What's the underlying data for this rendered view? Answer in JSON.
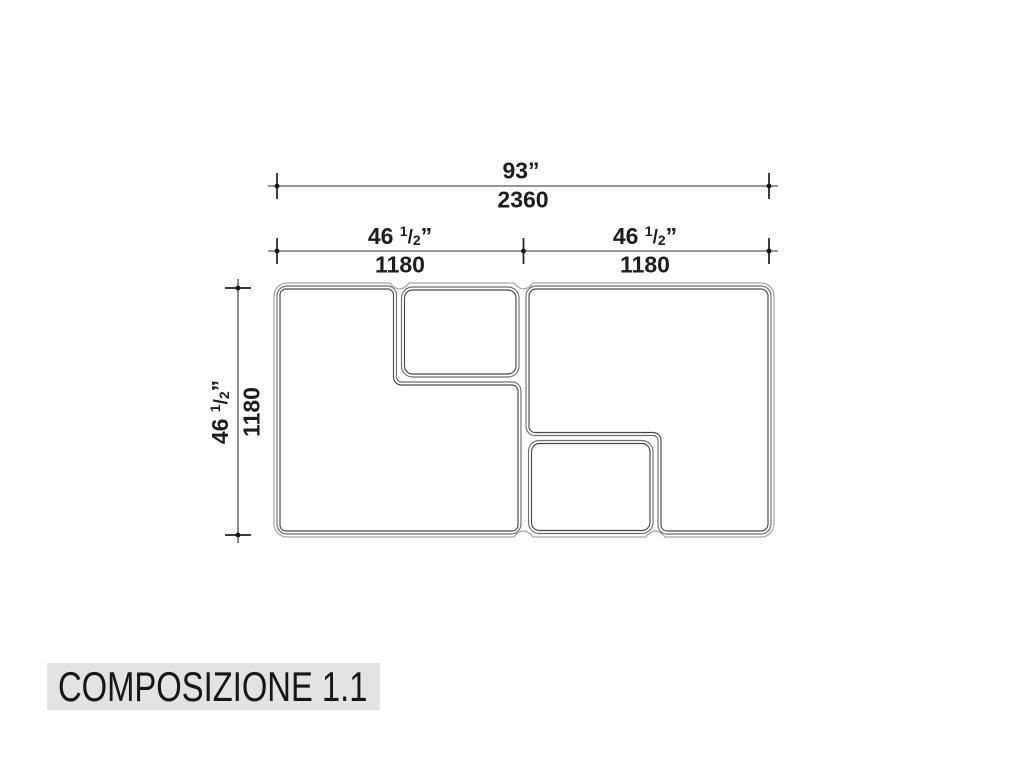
{
  "title": {
    "text": "COMPOSIZIONE 1.1"
  },
  "colors": {
    "background": "#ffffff",
    "title_bar": "#e3e3e3",
    "dimension_lines": "#2f2f2f",
    "outline_envelope": "#a6a6a6",
    "outline_outer": "#6e6e6e",
    "outline_inner": "#474747",
    "text": "#1d1d1d"
  },
  "dimensions": {
    "overall_width": {
      "inches": "93”",
      "mm": "2360"
    },
    "left_half_width": {
      "whole": "46",
      "num": "1",
      "slash": "/",
      "den": "2",
      "quote": "”",
      "mm": "1180"
    },
    "right_half_width": {
      "whole": "46",
      "num": "1",
      "slash": "/",
      "den": "2",
      "quote": "”",
      "mm": "1180"
    },
    "height": {
      "whole": "46",
      "num": "1",
      "slash": "/",
      "den": "2",
      "quote": "”",
      "mm": "1180"
    }
  },
  "drawing": {
    "description": "composition of 4 rounded modules: large L-shaped module left, small box top-center, small box bottom-center, large L-shaped module right",
    "module_count": 4
  }
}
